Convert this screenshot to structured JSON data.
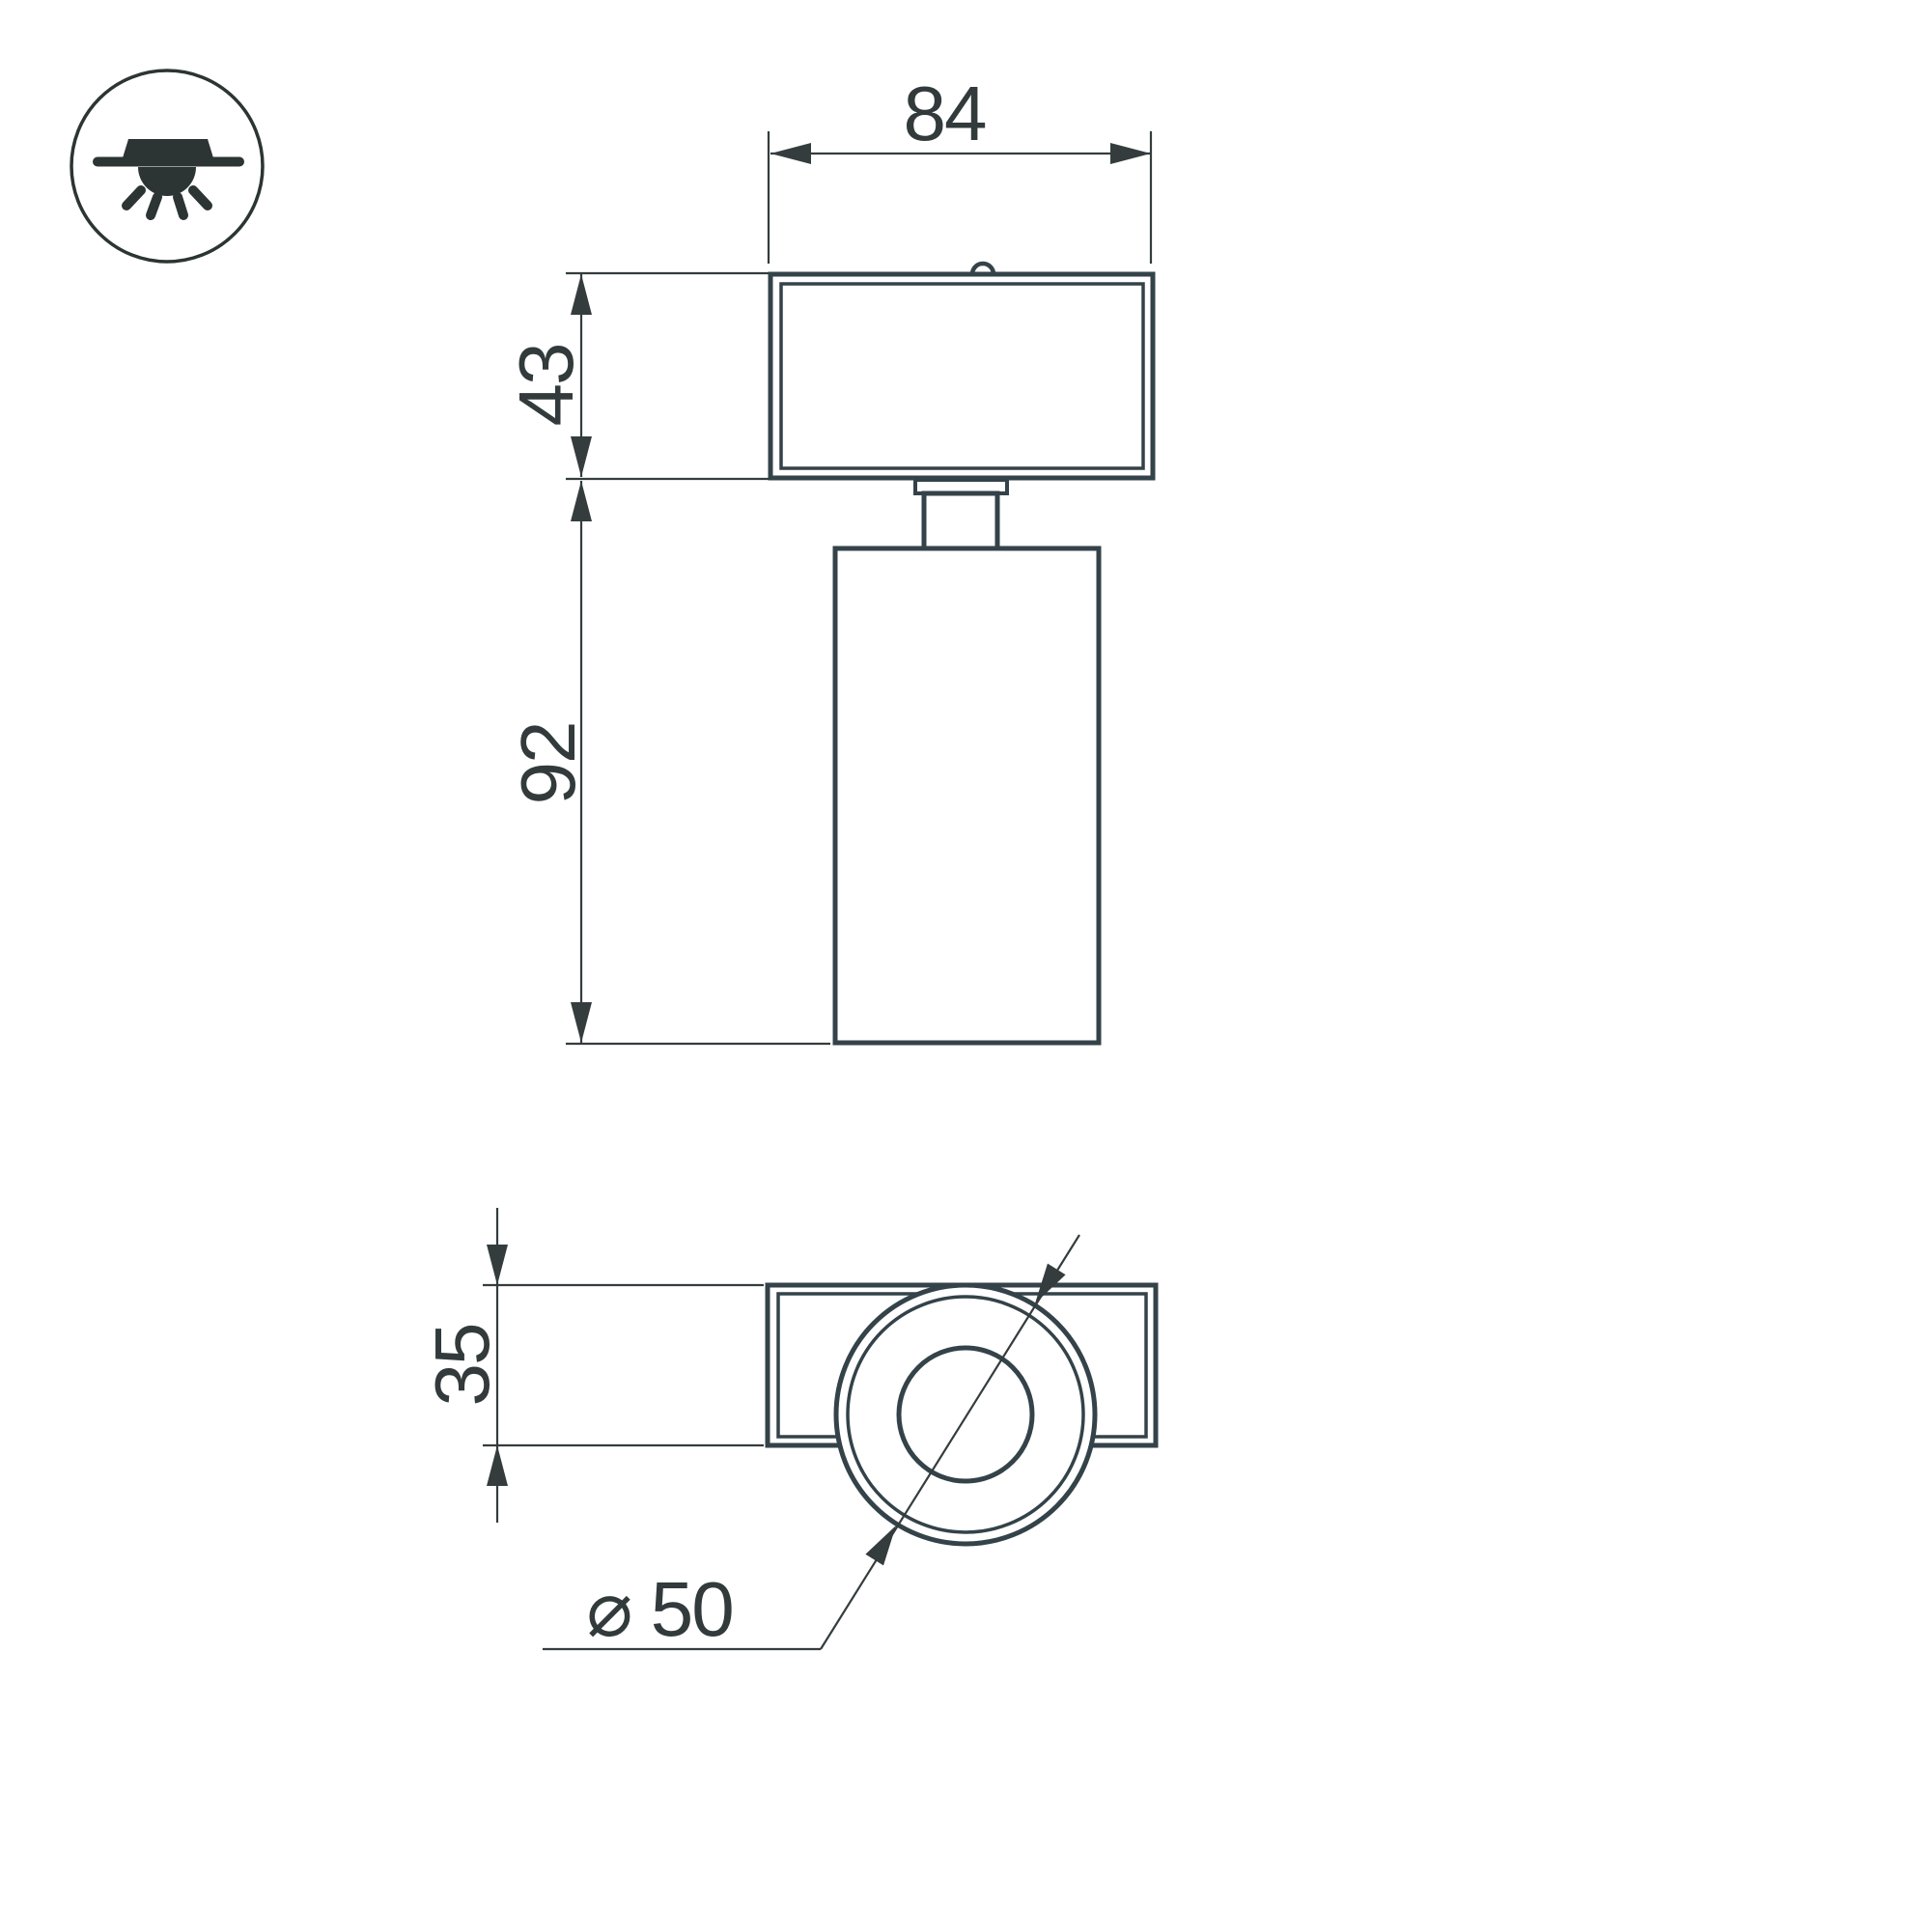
{
  "drawing": {
    "kind": "luminaire dimension drawing",
    "icon": {
      "name": "surface-ceiling-light-icon"
    },
    "dimensions": {
      "overall_width": "84",
      "bracket_height": "43",
      "body_length": "92",
      "bracket_depth": "35",
      "body_diameter": "⌀ 50"
    },
    "colors": {
      "fixture_line": "#344249",
      "dimension_ink": "#343c3e",
      "icon_ink": "#2c3534",
      "background": "#ffffff"
    }
  }
}
